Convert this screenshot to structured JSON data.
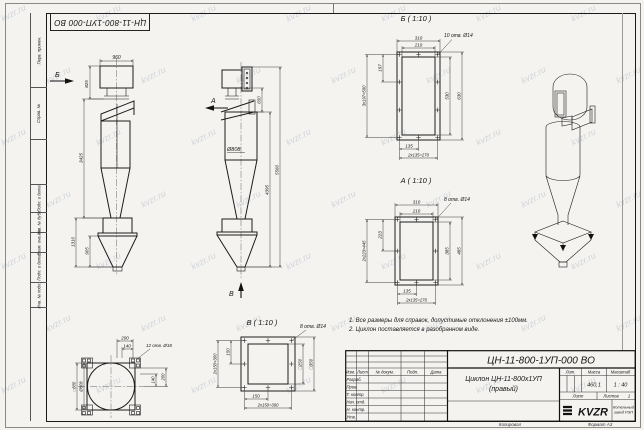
{
  "watermark": "kvzr.ru",
  "frame": {
    "stamp_top": "ЦН-11-800-1УП-000 ВО",
    "side_labels": [
      "Перв. примен.",
      "Справ. №",
      "Подп. и дата",
      "Инв. № дубл.",
      "Взам. инв. №",
      "Подп. и дата",
      "Инв. № подл."
    ]
  },
  "views": {
    "front": {
      "arrow_b": "Б",
      "arrow_a": "А",
      "dim_width_top": "960",
      "dim_h_outlet": "825",
      "dim_h_body": "3425",
      "dim_h_bunker": "1310",
      "dim_h_bunker_cone": "905"
    },
    "side": {
      "arrow_v": "В",
      "dim_outlet": "650",
      "dia_body": "Ø808",
      "dim_h_inner": "4395",
      "dim_h_total": "5560"
    },
    "section_b": {
      "title": "Б ( 1:10 )",
      "holes": "10 отв. Ø14",
      "dim_out_w": "310",
      "dim_in_w": "210",
      "dim_pitch": "197",
      "dim_pitch_total": "3x197=590",
      "dim_in_h": "530",
      "dim_out_h": "630",
      "dim_bot": "135",
      "dim_bot_total": "2x135=270"
    },
    "section_a": {
      "title": "А ( 1:10 )",
      "holes": "8 отв. Ø14",
      "dim_out_w": "310",
      "dim_in_w": "210",
      "dim_pitch": "223",
      "dim_pitch_total": "2x223=445",
      "dim_in_h": "385",
      "dim_out_h": "485",
      "dim_bot": "135",
      "dim_bot_total": "2x135=270"
    },
    "section_v": {
      "title": "В ( 1:10 )",
      "holes": "8 отв. Ø14",
      "dim_pitch": "150",
      "dim_pitch_total": "2x150=300",
      "dim_bot": "150",
      "dim_bot_total": "2x150=300",
      "dim_inner": "□250",
      "dim_outer": "□350"
    },
    "base": {
      "holes": "12 отв. Ø18",
      "dim_top_outer": "200",
      "dim_top_inner": "140",
      "dim_right_inner": "140",
      "dim_right_outer": "200",
      "dim_square": "□800",
      "dim_circle": "Ø808"
    }
  },
  "notes": [
    "1. Все размеры для справок, допустимые отклонения ±100мм.",
    "2. Циклон поставляется в разобранном виде."
  ],
  "title_block": {
    "doc_number": "ЦН-11-800-1УП-000 ВО",
    "name_line1": "Циклон ЦН-11-800х1УП",
    "name_line2": "(правый)",
    "header_cols": [
      "Изм.",
      "Лист",
      "№ докум.",
      "Подп.",
      "Дата"
    ],
    "row_labels": [
      "Разраб.",
      "Пров.",
      "Т. контр.",
      "Нач. отд.",
      "Н. контр.",
      "Утв."
    ],
    "lit_label": "Лит.",
    "mass_label": "Масса",
    "scale_label": "Масштаб",
    "mass_value": "460,1",
    "scale_value": "1 : 40",
    "sheet_label": "Лист",
    "sheets_label": "Листов",
    "sheets_value": "1",
    "logo_text": "KVZR",
    "company_line1": "Котельный",
    "company_line2": "завод РЭП",
    "copied_label": "Копировал",
    "format_label": "Формат А3"
  }
}
